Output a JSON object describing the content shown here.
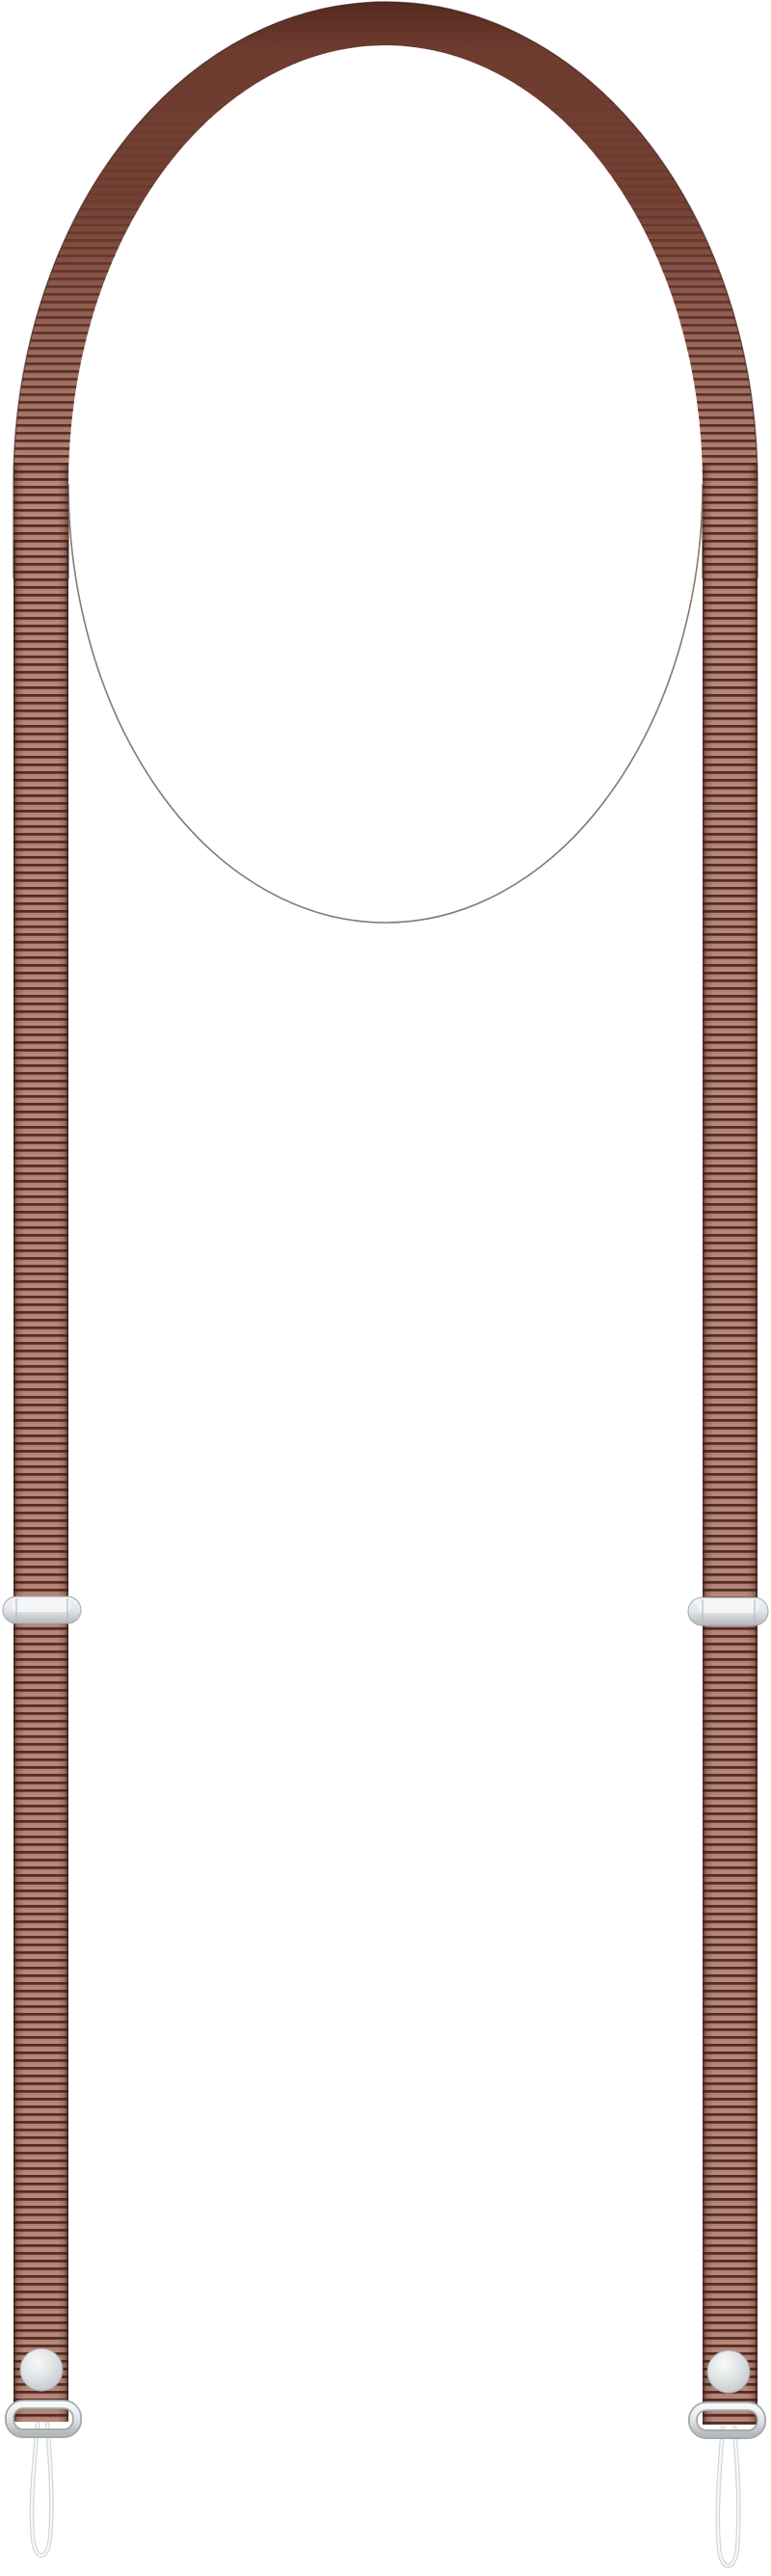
{
  "scene": {
    "alt": "Brown woven adjustable neck strap (lanyard) with silver metal slider buckles, snap buttons, metal end loops and thin translucent attachment cord loops, on a plain white background",
    "background": "#ffffff",
    "parts": [
      {
        "id": "strap-arch",
        "label": "smooth arched top of strap"
      },
      {
        "id": "left-strap",
        "label": "left ribbed webbing strap"
      },
      {
        "id": "right-strap",
        "label": "right ribbed webbing strap"
      },
      {
        "id": "left-adjuster",
        "label": "left silver slider buckle"
      },
      {
        "id": "right-adjuster",
        "label": "right silver slider buckle"
      },
      {
        "id": "left-snap-button",
        "label": "left silver snap button"
      },
      {
        "id": "right-snap-button",
        "label": "right silver snap button"
      },
      {
        "id": "left-end-loop",
        "label": "left silver end loop"
      },
      {
        "id": "right-end-loop",
        "label": "right silver end loop"
      },
      {
        "id": "left-cord-loop",
        "label": "left thin attachment cord loop"
      },
      {
        "id": "right-cord-loop",
        "label": "right thin attachment cord loop"
      }
    ]
  },
  "colors": {
    "background": "#ffffff",
    "webbing_light": "#b28374",
    "webbing_stripe": "#c49486",
    "webbing_dark": "#532c24",
    "webbing_edge": "#3a1e17",
    "leather": "#6e3b2f",
    "leather_dark": "#54291f",
    "metal_hi": "#f6f7f8",
    "metal_mid": "#e2e5e7",
    "metal_lo": "#b4b9bd",
    "metal_edge": "#a2a7ac",
    "snap_hi": "#f8f9f9",
    "snap_mid": "#dde0e2",
    "snap_lo": "#bfc4c7",
    "cord_outline": "#d3d5d6",
    "cord_core": "#f8f8f8"
  }
}
